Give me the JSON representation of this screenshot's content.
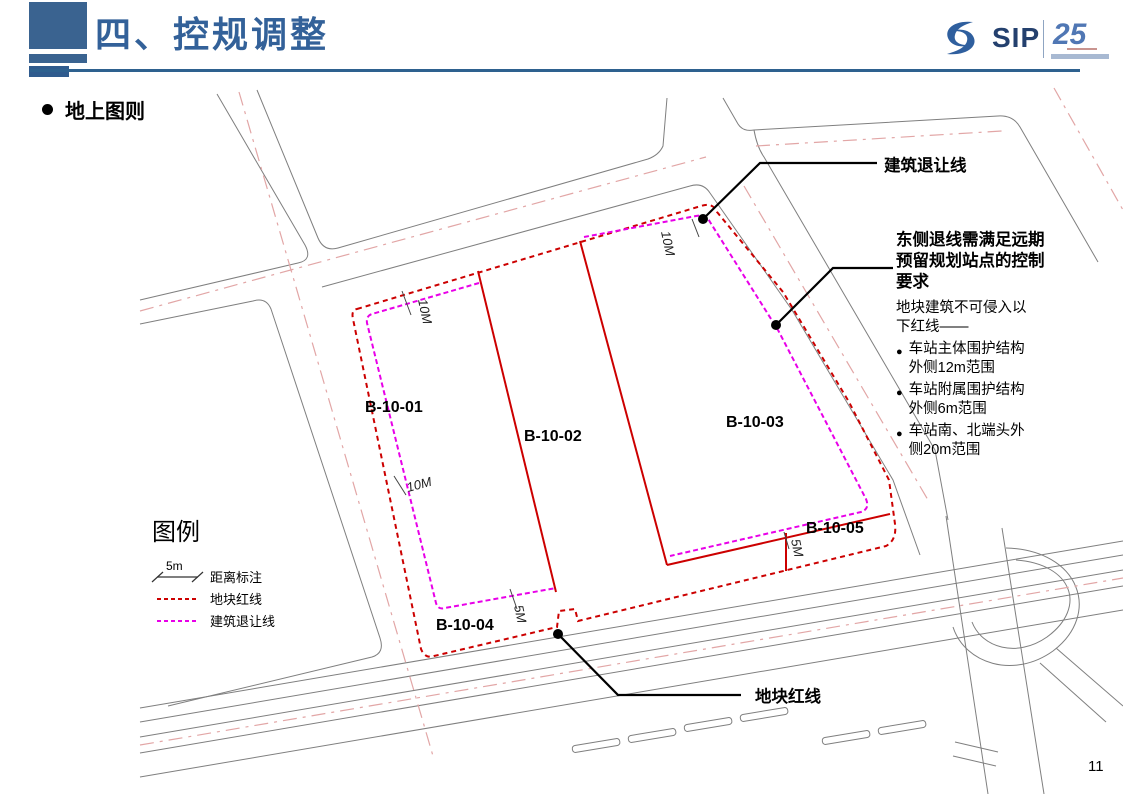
{
  "header": {
    "title": "四、控规调整",
    "section_bullet": "地上图则",
    "page_number": "11",
    "logo": {
      "sip_text": "SIP",
      "anniversary": "25"
    }
  },
  "map": {
    "parcels": [
      {
        "id": "B-10-01"
      },
      {
        "id": "B-10-02"
      },
      {
        "id": "B-10-03"
      },
      {
        "id": "B-10-04"
      },
      {
        "id": "B-10-05"
      }
    ],
    "dimension_labels": [
      {
        "text": "10M"
      },
      {
        "text": "10M"
      },
      {
        "text": "10M"
      },
      {
        "text": "5M"
      },
      {
        "text": "5M"
      }
    ],
    "annotations": {
      "setback_label": "建筑退让线",
      "redline_label": "地块红线"
    },
    "colors": {
      "parcel_red": "#CC0000",
      "setback_magenta": "#E800E8",
      "road_gray": "#7F7F7F",
      "centerline_pink": "#E2A6A6",
      "accent_blue": "#336199"
    }
  },
  "note": {
    "bullet_glyph": "●",
    "title_lines": [
      "东侧退线需满足远期",
      "预留规划站点的控制",
      "要求"
    ],
    "intro_lines": [
      "地块建筑不可侵入以",
      "下红线——"
    ],
    "bullets": [
      {
        "lines": [
          "车站主体围护结构",
          "外侧12m范围"
        ]
      },
      {
        "lines": [
          "车站附属围护结构",
          "外侧6m范围"
        ]
      },
      {
        "lines": [
          "车站南、北端头外",
          "侧20m范围"
        ]
      }
    ]
  },
  "legend": {
    "title": "图例",
    "scale_text": "5m",
    "items": [
      {
        "label": "距离标注"
      },
      {
        "label": "地块红线"
      },
      {
        "label": "建筑退让线"
      }
    ]
  }
}
